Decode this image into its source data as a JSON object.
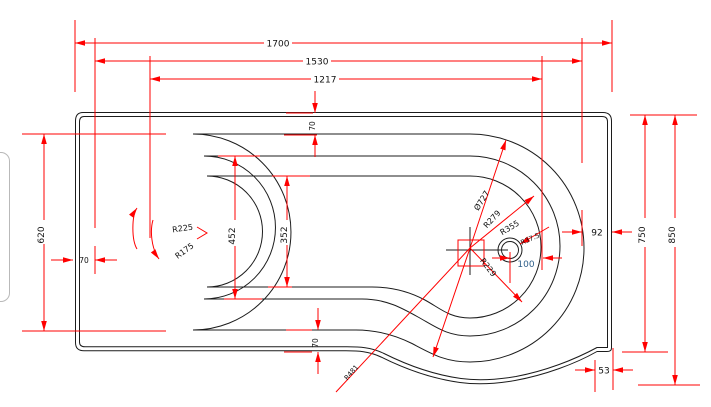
{
  "drawing": {
    "title": "P-shaped shower bath technical drawing, plan view",
    "dimensions": {
      "overall_length": "1700",
      "inner_length": "1530",
      "floor_length": "1217",
      "top_rim_offset": "70",
      "bottom_rim_offset": "70",
      "left_rim_offset": "70",
      "inner_height": "620",
      "inner_width_upper": "452",
      "floor_width": "352",
      "width_main": "750",
      "width_overall": "850",
      "right_gap": "92",
      "corner_offset": "53",
      "drain_offset": "100"
    },
    "radii": {
      "left_end_outer": "R225",
      "left_end_inner": "R175",
      "bowl_diameter": "Ø727",
      "bowl_mid": "R279",
      "bowl_outer": "R355",
      "drain_radius": "R37.5",
      "bowl_inner": "R229",
      "transition_radius": "R481"
    },
    "colors": {
      "dimension_lines": "#ff0000",
      "outline": "#1c1c1c",
      "drain_offset_text": "#2e5f8a",
      "background": "#ffffff"
    }
  }
}
